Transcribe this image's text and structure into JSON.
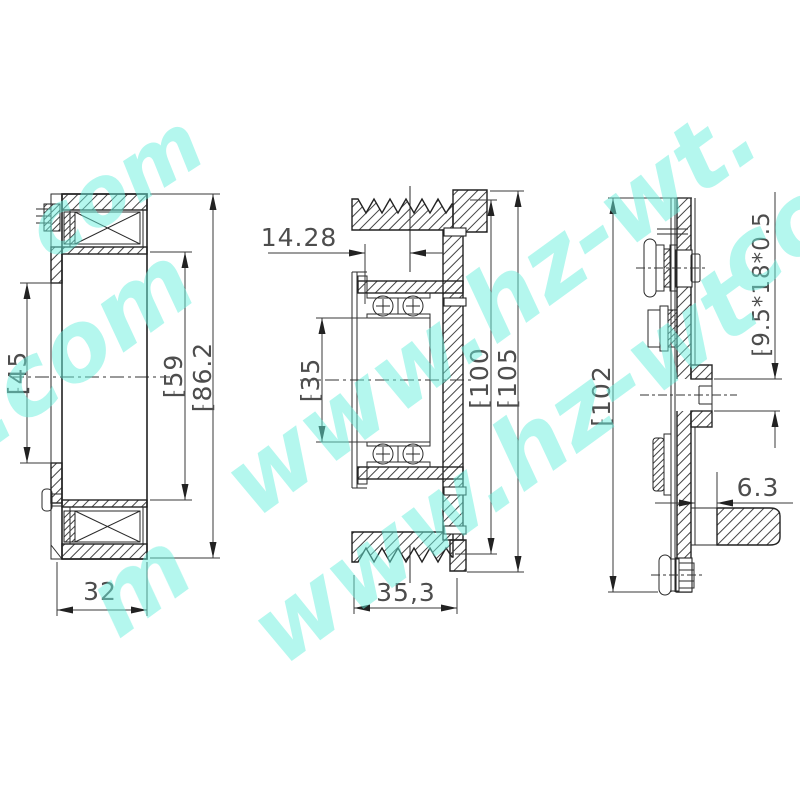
{
  "drawing": {
    "background": "#ffffff",
    "line_color": "#222222",
    "dim_color": "#4d4d4d",
    "watermark": {
      "text": "www.hz-wt.com",
      "color": "#68efdd",
      "fragments": [
        {
          "text": "t.com"
        },
        {
          "text": "com"
        },
        {
          "text": "www.hz-wt."
        },
        {
          "text": "m"
        },
        {
          "text": "www.hz-wt"
        },
        {
          "text": "co"
        }
      ]
    },
    "views": {
      "coil": {
        "name": "electromagnetic-coil-section",
        "dims": {
          "bore": "⁅45",
          "pole": "⁅59",
          "outer": "⁅86.2",
          "width": "32"
        }
      },
      "pulley": {
        "name": "pulley-bearing-section",
        "dims": {
          "groove_offset": "14.28",
          "bearing_bore": "⁅35",
          "groove_od": "⁅100",
          "flange_od": "⁅105",
          "width": "35,3"
        }
      },
      "hub": {
        "name": "clutch-hub-section",
        "dims": {
          "od": "⁅102",
          "spec": "⁅9.5*18*0.5",
          "gap": "6.3"
        }
      }
    }
  }
}
